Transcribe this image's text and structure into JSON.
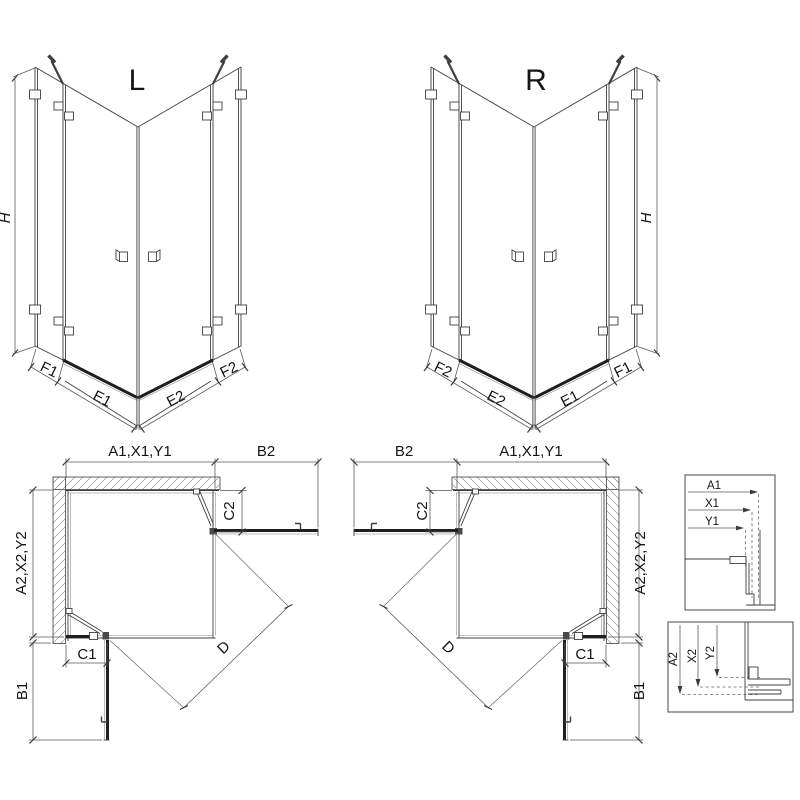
{
  "iso_left": {
    "view_label": "L",
    "height": "H",
    "front": {
      "f1": "F1",
      "e1": "E1",
      "e2": "E2",
      "f2": "F2"
    }
  },
  "iso_right": {
    "view_label": "R",
    "height": "H",
    "front": {
      "f2": "F2",
      "e2": "E2",
      "e1": "E1",
      "f1": "F1"
    }
  },
  "plan_left": {
    "top_width": "A1,X1,Y1",
    "side_door": "B2",
    "depth": "A2,X2,Y2",
    "fixed_top": "C2",
    "fixed_bottom": "C1",
    "front_door": "B1",
    "diagonal": "D"
  },
  "plan_right": {
    "top_width": "A1,X1,Y1",
    "side_door": "B2",
    "depth": "A2,X2,Y2",
    "fixed_top": "C2",
    "fixed_bottom": "C1",
    "front_door": "B1",
    "diagonal": "D"
  },
  "detail_width": {
    "a1": "A1",
    "x1": "X1",
    "y1": "Y1"
  },
  "detail_depth": {
    "a2": "A2",
    "x2": "X2",
    "y2": "Y2"
  },
  "colors": {
    "line": "#3f3f3f",
    "thick": "#1f1f1f",
    "dim": "#5a5a5a",
    "hatch": "#9a9a9a",
    "text": "#141414",
    "background": "#ffffff"
  }
}
